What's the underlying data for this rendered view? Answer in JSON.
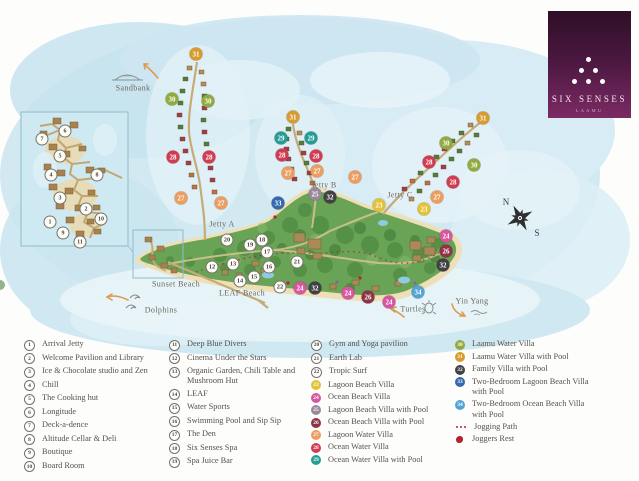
{
  "logo": {
    "name": "SIX SENSES",
    "location": "LAAMU"
  },
  "marker_colors": {
    "23": "#e2c237",
    "24": "#d6569f",
    "25": "#99889a",
    "26": "#8e3345",
    "27": "#eb9e60",
    "28": "#d23c52",
    "29": "#259d95",
    "30": "#91aa3d",
    "31": "#d79b2f",
    "32": "#414143",
    "33": "#3568ac",
    "34": "#53a4d4"
  },
  "map": {
    "labels": {
      "sandbank": "Sandbank",
      "jetty_a": "Jetty A",
      "jetty_b": "Jetty B",
      "jetty_c": "Jetty C",
      "sunset_beach": "Sunset Beach",
      "leaf_beach": "LEAF Beach",
      "dolphins": "Dolphins",
      "turtles": "Turtles",
      "yin_yang": "Yin Yang",
      "north": "N",
      "south": "S"
    },
    "markers": [
      {
        "n": 31,
        "x": 196,
        "y": 54,
        "c": "31"
      },
      {
        "n": 30,
        "x": 172,
        "y": 99,
        "c": "30"
      },
      {
        "n": 30,
        "x": 208,
        "y": 101,
        "c": "30"
      },
      {
        "n": 28,
        "x": 173,
        "y": 157,
        "c": "28"
      },
      {
        "n": 28,
        "x": 209,
        "y": 157,
        "c": "28"
      },
      {
        "n": 27,
        "x": 181,
        "y": 198,
        "c": "27"
      },
      {
        "n": 27,
        "x": 221,
        "y": 203,
        "c": "27"
      },
      {
        "n": 31,
        "x": 293,
        "y": 117,
        "c": "31"
      },
      {
        "n": 29,
        "x": 281,
        "y": 138,
        "c": "29"
      },
      {
        "n": 29,
        "x": 311,
        "y": 138,
        "c": "29"
      },
      {
        "n": 28,
        "x": 282,
        "y": 155,
        "c": "28"
      },
      {
        "n": 28,
        "x": 316,
        "y": 156,
        "c": "28"
      },
      {
        "n": 27,
        "x": 288,
        "y": 173,
        "c": "27"
      },
      {
        "n": 27,
        "x": 317,
        "y": 171,
        "c": "27"
      },
      {
        "n": 31,
        "x": 483,
        "y": 118,
        "c": "31"
      },
      {
        "n": 30,
        "x": 446,
        "y": 143,
        "c": "30"
      },
      {
        "n": 30,
        "x": 474,
        "y": 165,
        "c": "30"
      },
      {
        "n": 28,
        "x": 429,
        "y": 162,
        "c": "28"
      },
      {
        "n": 28,
        "x": 453,
        "y": 182,
        "c": "28"
      },
      {
        "n": 27,
        "x": 437,
        "y": 197,
        "c": "27"
      },
      {
        "n": 27,
        "x": 355,
        "y": 177,
        "c": "27"
      },
      {
        "n": 23,
        "x": 379,
        "y": 205,
        "c": "23"
      },
      {
        "n": 23,
        "x": 424,
        "y": 209,
        "c": "23"
      },
      {
        "n": 25,
        "x": 315,
        "y": 194,
        "c": "25"
      },
      {
        "n": 32,
        "x": 330,
        "y": 197,
        "c": "32"
      },
      {
        "n": 33,
        "x": 278,
        "y": 203,
        "c": "33"
      },
      {
        "n": 24,
        "x": 446,
        "y": 236,
        "c": "24"
      },
      {
        "n": 26,
        "x": 446,
        "y": 251,
        "c": "26"
      },
      {
        "n": 32,
        "x": 443,
        "y": 265,
        "c": "32"
      },
      {
        "n": 34,
        "x": 418,
        "y": 292,
        "c": "34"
      },
      {
        "n": 24,
        "x": 389,
        "y": 302,
        "c": "24"
      },
      {
        "n": 26,
        "x": 368,
        "y": 297,
        "c": "26"
      },
      {
        "n": 24,
        "x": 348,
        "y": 293,
        "c": "24"
      },
      {
        "n": 32,
        "x": 315,
        "y": 288,
        "c": "32"
      },
      {
        "n": 24,
        "x": 300,
        "y": 288,
        "c": "24"
      },
      {
        "n": 12,
        "x": 212,
        "y": 267,
        "c": "w"
      },
      {
        "n": 13,
        "x": 233,
        "y": 264,
        "c": "w"
      },
      {
        "n": 14,
        "x": 240,
        "y": 281,
        "c": "w"
      },
      {
        "n": 15,
        "x": 254,
        "y": 277,
        "c": "w"
      },
      {
        "n": 16,
        "x": 269,
        "y": 267,
        "c": "w"
      },
      {
        "n": 17,
        "x": 267,
        "y": 252,
        "c": "w"
      },
      {
        "n": 18,
        "x": 262,
        "y": 240,
        "c": "w"
      },
      {
        "n": 19,
        "x": 250,
        "y": 245,
        "c": "w"
      },
      {
        "n": 20,
        "x": 227,
        "y": 240,
        "c": "w"
      },
      {
        "n": 21,
        "x": 297,
        "y": 262,
        "c": "w"
      },
      {
        "n": 22,
        "x": 280,
        "y": 287,
        "c": "w"
      }
    ],
    "inset_markers": [
      {
        "n": 1,
        "x": 50,
        "y": 222
      },
      {
        "n": 2,
        "x": 86,
        "y": 209
      },
      {
        "n": 3,
        "x": 60,
        "y": 198
      },
      {
        "n": 4,
        "x": 51,
        "y": 175
      },
      {
        "n": 5,
        "x": 60,
        "y": 156
      },
      {
        "n": 6,
        "x": 65,
        "y": 131
      },
      {
        "n": 7,
        "x": 42,
        "y": 139
      },
      {
        "n": 8,
        "x": 97,
        "y": 175
      },
      {
        "n": 9,
        "x": 63,
        "y": 233
      },
      {
        "n": 10,
        "x": 101,
        "y": 219
      },
      {
        "n": 11,
        "x": 80,
        "y": 242
      }
    ]
  },
  "legend": {
    "columns": [
      [
        {
          "n": "1",
          "c": "w",
          "label": "Arrival Jetty"
        },
        {
          "n": "2",
          "c": "w",
          "label": "Welcome Pavilion and Library"
        },
        {
          "n": "3",
          "c": "w",
          "label": "Ice & Chocolate studio and Zen"
        },
        {
          "n": "4",
          "c": "w",
          "label": "Chill"
        },
        {
          "n": "5",
          "c": "w",
          "label": "The Cooking hut"
        },
        {
          "n": "6",
          "c": "w",
          "label": "Longitude"
        },
        {
          "n": "7",
          "c": "w",
          "label": "Deck-a-dence"
        },
        {
          "n": "8",
          "c": "w",
          "label": "Altitude Cellar & Deli"
        },
        {
          "n": "9",
          "c": "w",
          "label": "Boutique"
        },
        {
          "n": "10",
          "c": "w",
          "label": "Board Room"
        }
      ],
      [
        {
          "n": "11",
          "c": "w",
          "label": "Deep Blue Divers"
        },
        {
          "n": "12",
          "c": "w",
          "label": "Cinema Under the Stars"
        },
        {
          "n": "13",
          "c": "w",
          "label": "Organic Garden, Chili Table and Mushroom Hut"
        },
        {
          "n": "14",
          "c": "w",
          "label": "LEAF"
        },
        {
          "n": "15",
          "c": "w",
          "label": "Water Sports"
        },
        {
          "n": "16",
          "c": "w",
          "label": "Swimming Pool and Sip Sip"
        },
        {
          "n": "17",
          "c": "w",
          "label": "The Den"
        },
        {
          "n": "18",
          "c": "w",
          "label": "Six Senses Spa"
        },
        {
          "n": "19",
          "c": "w",
          "label": "Spa Juice Bar"
        }
      ],
      [
        {
          "n": "20",
          "c": "w",
          "label": "Gym and Yoga pavilion"
        },
        {
          "n": "21",
          "c": "w",
          "label": "Earth Lab"
        },
        {
          "n": "22",
          "c": "w",
          "label": "Tropic Surf"
        },
        {
          "n": "23",
          "c": "23",
          "label": "Lagoon Beach Villa"
        },
        {
          "n": "24",
          "c": "24",
          "label": "Ocean Beach Villa"
        },
        {
          "n": "25",
          "c": "25",
          "label": "Lagoon Beach Villa with Pool"
        },
        {
          "n": "26",
          "c": "26",
          "label": "Ocean Beach Villa with Pool"
        },
        {
          "n": "27",
          "c": "27",
          "label": "Lagoon Water Villa"
        },
        {
          "n": "28",
          "c": "28",
          "label": "Ocean Water Villa"
        },
        {
          "n": "29",
          "c": "29",
          "label": "Ocean Water Villa with Pool"
        }
      ],
      [
        {
          "n": "30",
          "c": "30",
          "label": "Laamu Water Villa"
        },
        {
          "n": "31",
          "c": "31",
          "label": "Laamu Water Villa with Pool"
        },
        {
          "n": "32",
          "c": "32",
          "label": "Family Villa with Pool"
        },
        {
          "n": "33",
          "c": "33",
          "label": "Two-Bedroom Lagoon Beach Villa with Pool"
        },
        {
          "n": "34",
          "c": "34",
          "label": "Two-Bedroom Ocean Beach Villa with Pool"
        },
        {
          "type": "jog",
          "label": "Jogging Path"
        },
        {
          "type": "rest",
          "label": "Joggers Rest"
        }
      ]
    ]
  }
}
